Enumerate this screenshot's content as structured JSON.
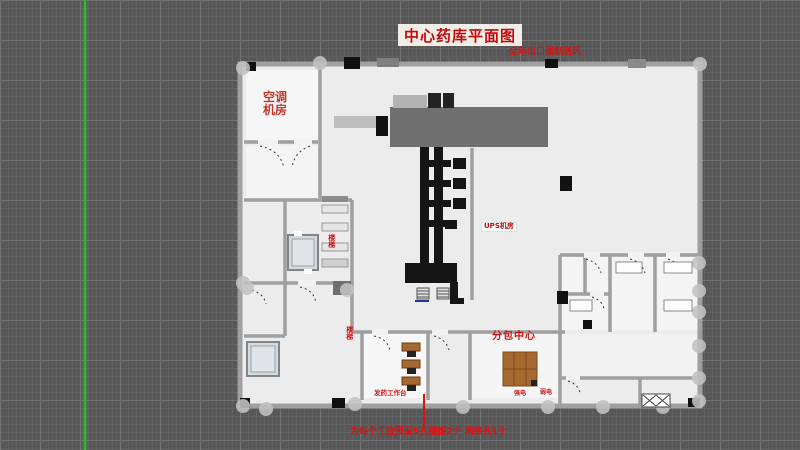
{
  "title": {
    "text": "中心药库平面图"
  },
  "annotations": {
    "top_note": "全年出口强制送风",
    "ac_line1": "空调",
    "ac_line2": "机房",
    "ups_room": "UPS机房",
    "packing_center": "分包中心",
    "desk_note": "发药工作台",
    "small_room_1": "强电",
    "small_room_2": "弱电",
    "stair_1": "楼梯",
    "stair_2": "楼梯",
    "bottom_note": "为每个工位预留5孔插座2个 网络孔1个"
  },
  "colors": {
    "canvas_bg": "#585858",
    "grid_minor": "#616161",
    "grid_major": "#737373",
    "green_guide": "#2db92d",
    "annotation_red": "#c30b0b",
    "floor": "#ececec",
    "wall_gray": "#9f9f9f",
    "machine_gray": "#6f6f6f",
    "ink_black": "#151515",
    "wood_brown": "#a5682e",
    "elevator_fill": "#d6dadd"
  }
}
